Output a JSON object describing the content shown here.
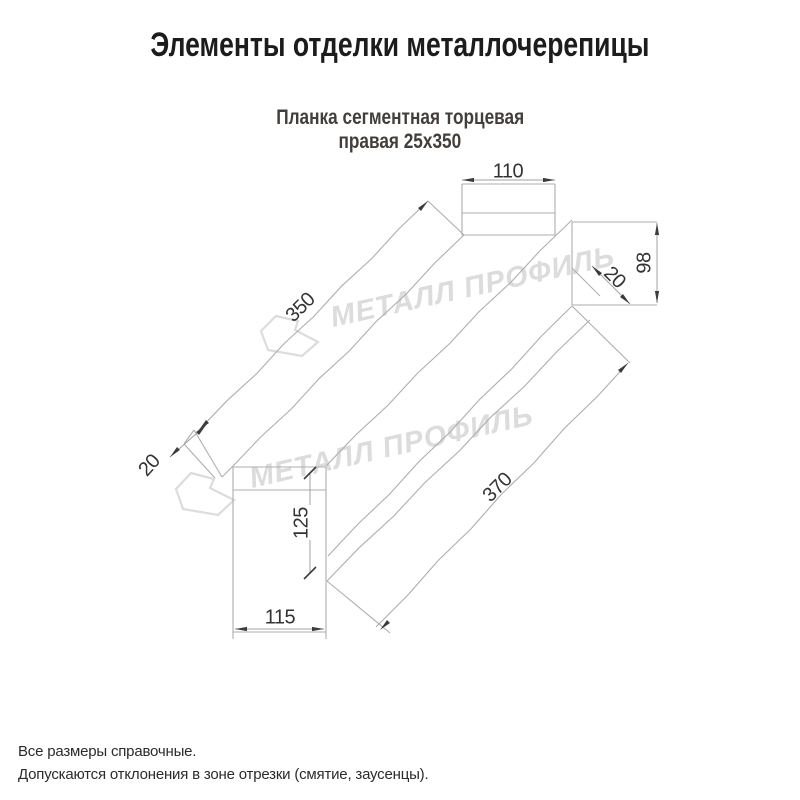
{
  "header": {
    "title": "Элементы отделки металлочерепицы"
  },
  "subtitle": {
    "line1": "Планка сегментная торцевая",
    "line2": "правая 25х350"
  },
  "notes": {
    "line1": "Все размеры справочные.",
    "line2": "Допускаются отклонения в зоне отрезки (смятие, заусенцы)."
  },
  "watermark": {
    "text": "МЕТАЛЛ ПРОФИЛЬ",
    "color": "#dcdcdc",
    "instances": [
      {
        "x": 333,
        "y": 327,
        "rotate": -12.4,
        "size": 29
      },
      {
        "x": 252,
        "y": 488,
        "rotate": -12.8,
        "size": 29
      }
    ],
    "logos": [
      [
        [
          276,
          316
        ],
        [
          298,
          321
        ],
        [
          295,
          330
        ],
        [
          318,
          342
        ],
        [
          302,
          356
        ],
        [
          268,
          350
        ],
        [
          261,
          331
        ]
      ],
      [
        [
          191,
          473
        ],
        [
          214,
          479
        ],
        [
          210,
          488
        ],
        [
          234,
          500
        ],
        [
          218,
          515
        ],
        [
          183,
          509
        ],
        [
          176,
          489
        ]
      ]
    ]
  },
  "drawing": {
    "line_color": "#aeaeae",
    "dim_color": "#a2a2a2",
    "arrow_color": "#3c3c3c",
    "label_color": "#333333",
    "wavy_lines": [
      [
        428,
        201,
        199,
        430
      ],
      [
        464,
        235,
        233,
        466
      ],
      [
        572,
        220,
        326,
        466
      ],
      [
        572,
        306,
        328,
        556
      ],
      [
        590,
        320,
        327,
        581
      ],
      [
        376,
        627,
        628,
        363
      ]
    ],
    "segments": [
      [
        462,
        184,
        555,
        184
      ],
      [
        555,
        184,
        555,
        235
      ],
      [
        555,
        235,
        462,
        235
      ],
      [
        462,
        235,
        462,
        184
      ],
      [
        462,
        213,
        555,
        213
      ],
      [
        572,
        222,
        657,
        222
      ],
      [
        572,
        305,
        657,
        305
      ],
      [
        572,
        222,
        572,
        305
      ],
      [
        233,
        467,
        326,
        467
      ],
      [
        326,
        467,
        326,
        632
      ],
      [
        326,
        632,
        233,
        632
      ],
      [
        233,
        632,
        233,
        467
      ],
      [
        233,
        490,
        326,
        490
      ],
      [
        233,
        632,
        233,
        639
      ],
      [
        326,
        632,
        326,
        639
      ],
      [
        428,
        201,
        464,
        235
      ],
      [
        572,
        306,
        630,
        363
      ],
      [
        572,
        268,
        600,
        296
      ],
      [
        327,
        581,
        390,
        633
      ],
      [
        194,
        430,
        222,
        477
      ],
      [
        184,
        444,
        215,
        478
      ],
      [
        194,
        430,
        184,
        444
      ],
      [
        222,
        477,
        233,
        466
      ]
    ],
    "dim_lines": [
      [
        462,
        180,
        555,
        180
      ],
      [
        657,
        223,
        657,
        303
      ],
      [
        592,
        266,
        630,
        304
      ],
      [
        170,
        457,
        206,
        425
      ],
      [
        310,
        473,
        310,
        505
      ],
      [
        310,
        540,
        310,
        573
      ],
      [
        235,
        629,
        324,
        629
      ]
    ],
    "ticks": [
      [
        304,
        479,
        316,
        467
      ],
      [
        304,
        579,
        316,
        567
      ]
    ],
    "arrows": [
      {
        "x": 462,
        "y": 180,
        "angle": 180
      },
      {
        "x": 555,
        "y": 180,
        "angle": 0
      },
      {
        "x": 657,
        "y": 223,
        "angle": -90
      },
      {
        "x": 657,
        "y": 303,
        "angle": 90
      },
      {
        "x": 428,
        "y": 201,
        "angle": -45
      },
      {
        "x": 199,
        "y": 430,
        "angle": 135
      },
      {
        "x": 628,
        "y": 363,
        "angle": -45
      },
      {
        "x": 380,
        "y": 630,
        "angle": 135
      },
      {
        "x": 592,
        "y": 266,
        "angle": -135
      },
      {
        "x": 630,
        "y": 304,
        "angle": 45
      },
      {
        "x": 206,
        "y": 425,
        "angle": -45
      },
      {
        "x": 170,
        "y": 457,
        "angle": 135
      },
      {
        "x": 235,
        "y": 629,
        "angle": 180
      },
      {
        "x": 324,
        "y": 629,
        "angle": 0
      }
    ],
    "labels": [
      {
        "text": "110",
        "x": 508,
        "y": 172,
        "rotate": 0
      },
      {
        "text": "98",
        "x": 645,
        "y": 263,
        "rotate": -90
      },
      {
        "text": "20",
        "x": 614,
        "y": 278,
        "rotate": 45
      },
      {
        "text": "350",
        "x": 301,
        "y": 308,
        "rotate": -45
      },
      {
        "text": "370",
        "x": 498,
        "y": 488,
        "rotate": -45
      },
      {
        "text": "20",
        "x": 150,
        "y": 466,
        "rotate": -48
      },
      {
        "text": "125",
        "x": 302,
        "y": 523,
        "rotate": -90
      },
      {
        "text": "115",
        "x": 280,
        "y": 618,
        "rotate": 0
      }
    ]
  }
}
